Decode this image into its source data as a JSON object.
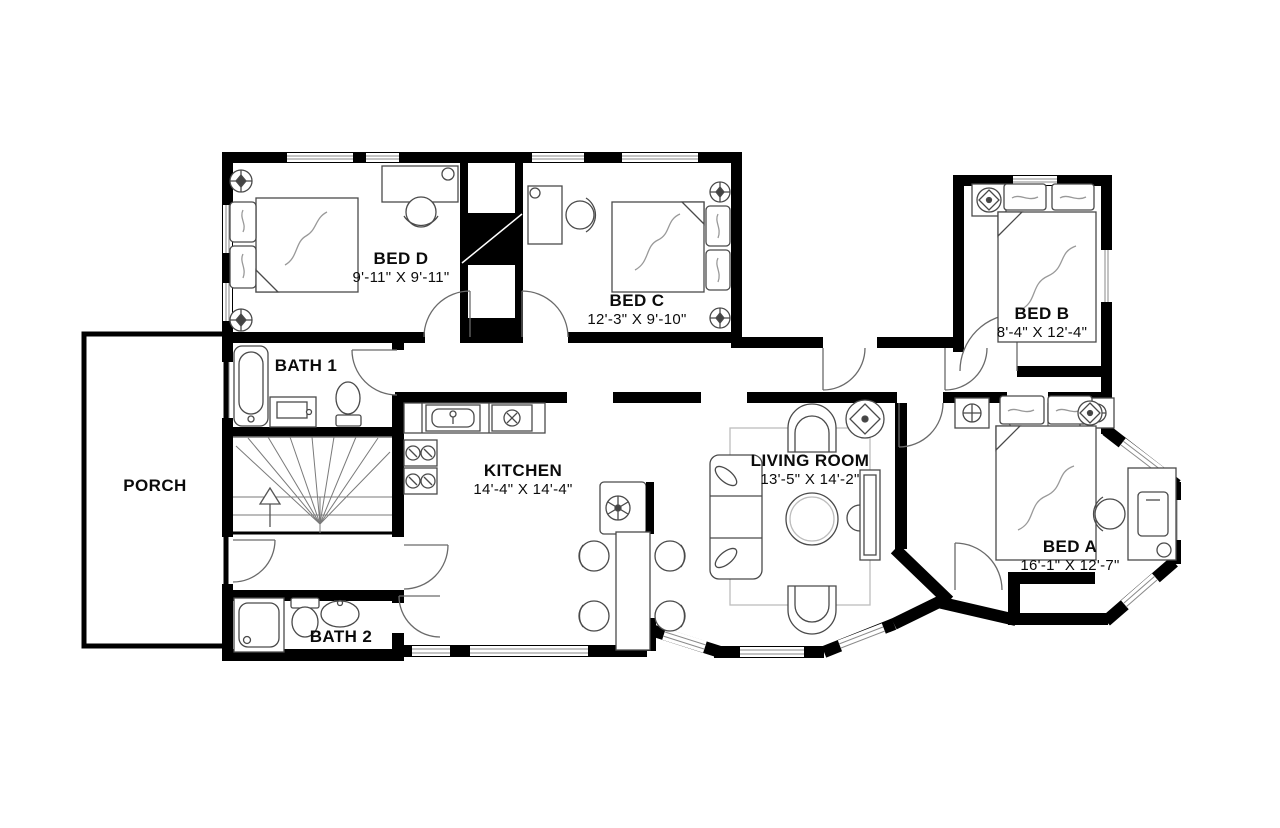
{
  "title": "Apartment floor plan",
  "colors": {
    "wall": "#000000",
    "background": "#ffffff",
    "furniture_line": "#4a4a4a",
    "detail_line": "#999999",
    "text": "#0b0b0b"
  },
  "rooms": {
    "bed_d": {
      "name": "BED D",
      "dims": "9'-11\" X 9'-11\""
    },
    "bed_c": {
      "name": "BED C",
      "dims": "12'-3\" X 9'-10\""
    },
    "bed_b": {
      "name": "BED B",
      "dims": "8'-4\" X 12'-4\""
    },
    "bed_a": {
      "name": "BED A",
      "dims": "16'-1\" X 12'-7\""
    },
    "kitchen": {
      "name": "KITCHEN",
      "dims": "14'-4\" X 14'-4\""
    },
    "living": {
      "name": "LIVING ROOM",
      "dims": "13'-5\" X 14'-2\""
    },
    "bath_1": {
      "name": "BATH 1"
    },
    "bath_2": {
      "name": "BATH 2"
    },
    "porch": {
      "name": "PORCH"
    }
  },
  "furniture": {
    "bed_d": [
      "double-bed",
      "pillows",
      "desk",
      "chair",
      "ceiling-light",
      "ceiling-light"
    ],
    "bed_c": [
      "double-bed",
      "pillows",
      "desk",
      "chair",
      "ceiling-light",
      "ceiling-light"
    ],
    "bed_b": [
      "double-bed",
      "pillows",
      "ceiling-fan"
    ],
    "bed_a": [
      "double-bed",
      "pillows",
      "nightstand",
      "nightstand",
      "desk",
      "chair",
      "ceiling-fan"
    ],
    "kitchen": [
      "counter",
      "sink",
      "cooktop",
      "stove",
      "island-hood",
      "dining-table",
      "chairs"
    ],
    "living": [
      "sofa",
      "armchair",
      "armchair",
      "coffee-table",
      "tv-console",
      "rug",
      "ceiling-fan"
    ],
    "bath_1": [
      "bathtub",
      "vanity-sink",
      "toilet"
    ],
    "bath_2": [
      "shower",
      "toilet",
      "sink"
    ],
    "stairs": [
      "winder-staircase",
      "up-arrow"
    ]
  }
}
